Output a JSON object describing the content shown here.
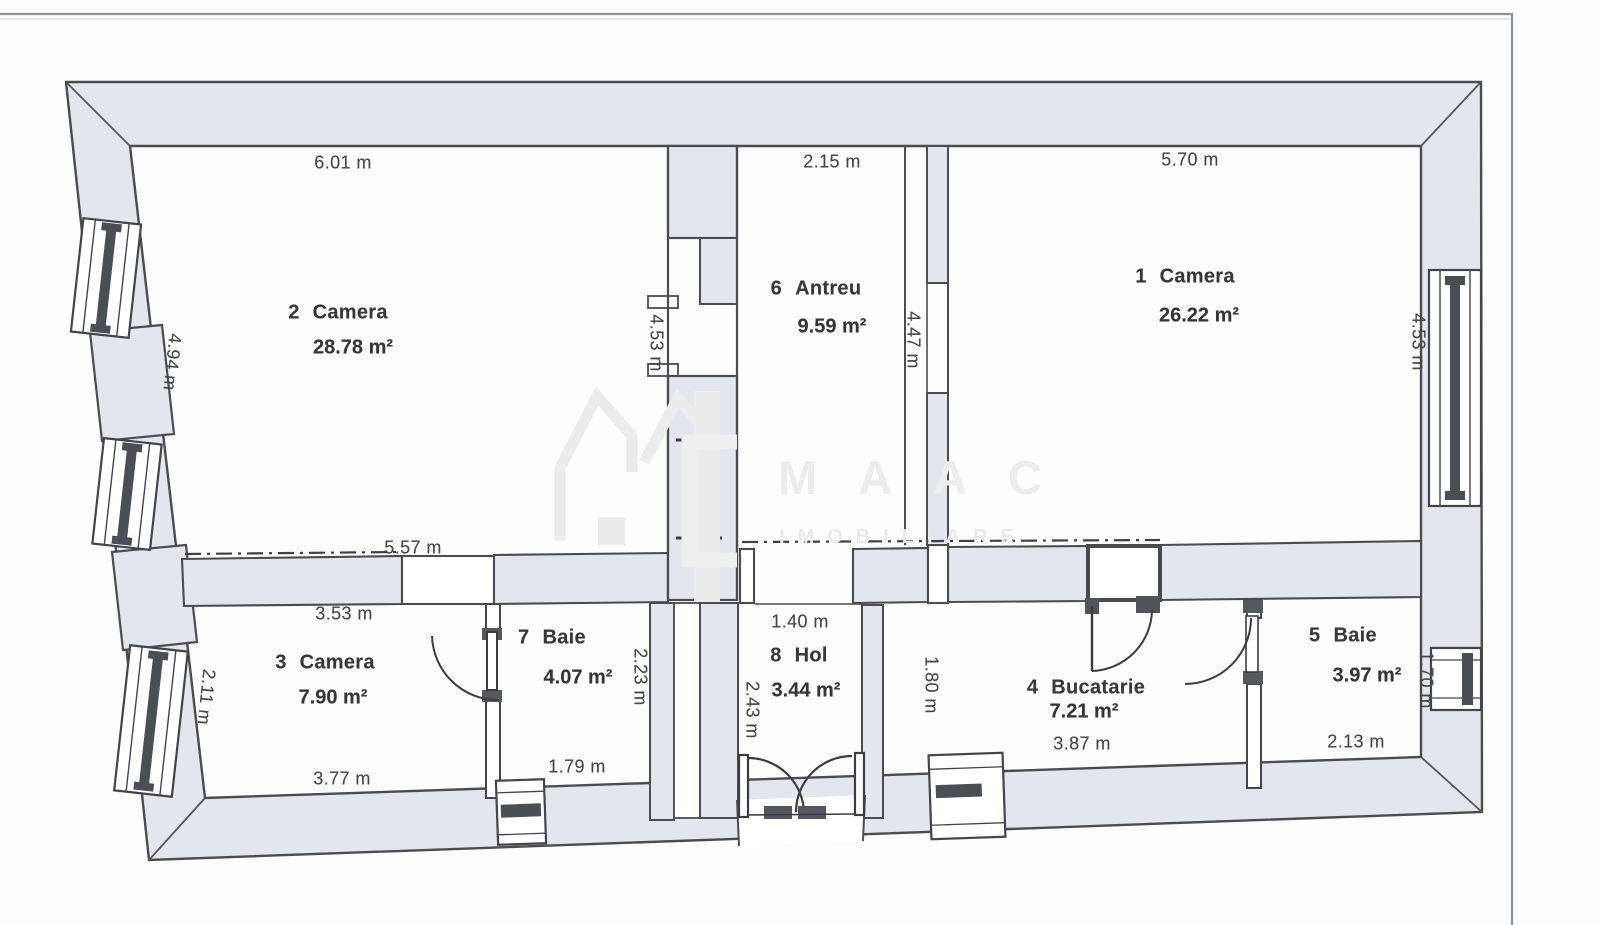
{
  "watermark": {
    "brand": "MAAC",
    "tagline": "IMOBILIARE"
  },
  "rooms": [
    {
      "number": "1",
      "name": "Camera",
      "area": "26.22 m²"
    },
    {
      "number": "2",
      "name": "Camera",
      "area": "28.78 m²"
    },
    {
      "number": "3",
      "name": "Camera",
      "area": "7.90 m²"
    },
    {
      "number": "4",
      "name": "Bucatarie",
      "area": "7.21 m²"
    },
    {
      "number": "5",
      "name": "Baie",
      "area": "3.97 m²"
    },
    {
      "number": "6",
      "name": "Antreu",
      "area": "9.59 m²"
    },
    {
      "number": "7",
      "name": "Baie",
      "area": "4.07 m²"
    },
    {
      "number": "8",
      "name": "Hol",
      "area": "3.44 m²"
    }
  ],
  "dimensions": {
    "room2_top": "6.01 m",
    "antreu_top": "2.15 m",
    "room1_top": "5.70 m",
    "room2_left": "4.94 m",
    "antreu_left": "4.53 m",
    "antreu_right": "4.47 m",
    "room1_right": "4.53 m",
    "room2_bottom": "5.57 m",
    "room3_top": "3.53 m",
    "room3_left": "2.11 m",
    "room3_bottom": "3.77 m",
    "baie7_bottom": "1.79 m",
    "baie7_right": "2.23 m",
    "hol_top": "1.40 m",
    "hol_left": "2.43 m",
    "bucatarie_left": "1.80 m",
    "bucatarie_bottom": "3.87 m",
    "baie5_bottom": "2.13 m",
    "baie5_right": "1.70 m"
  }
}
